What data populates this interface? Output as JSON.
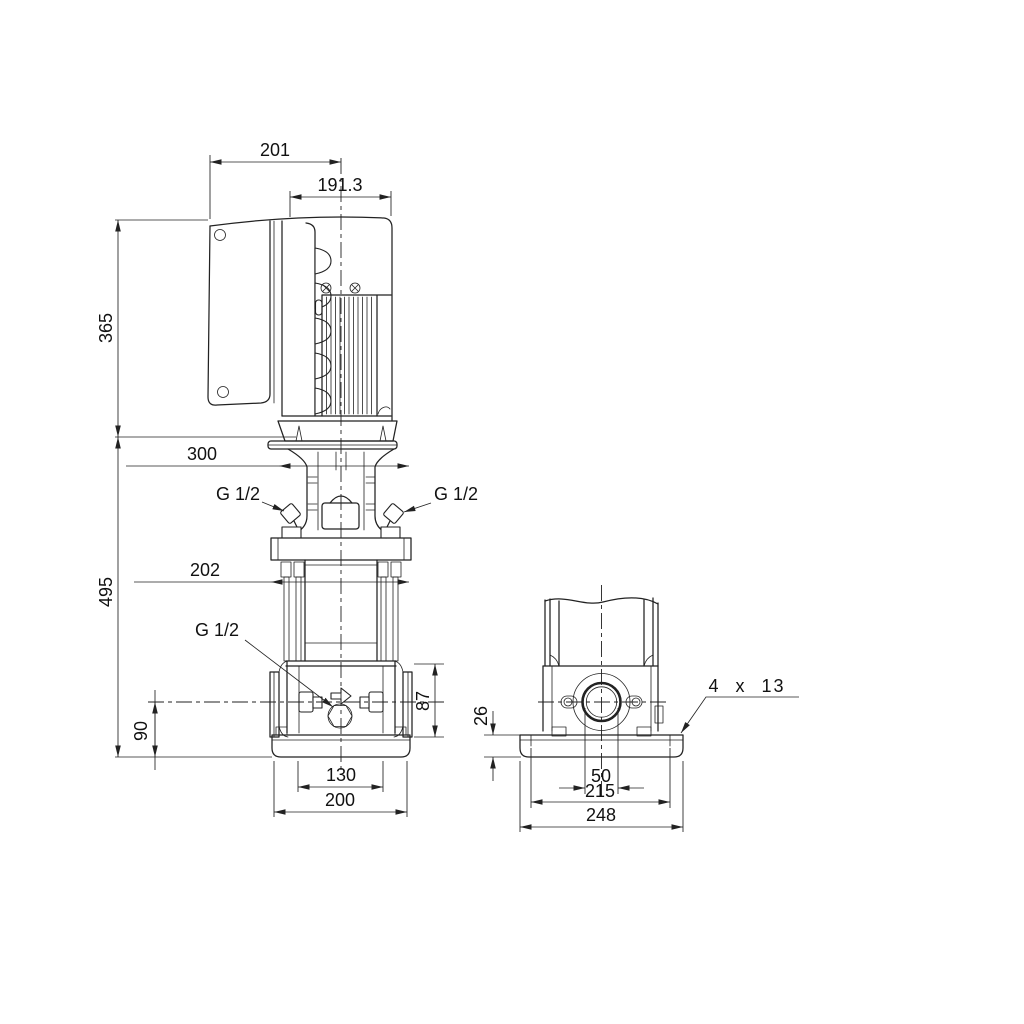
{
  "page": {
    "background_color": "#ffffff",
    "line_color": "#222222",
    "content_type": "pump-dimensional-drawing"
  },
  "drawing": {
    "views": {
      "side_view": {
        "dims": {
          "control_box_depth": "201",
          "motor_width": "191.3",
          "motor_height": "365",
          "head_depth": "300",
          "pump_height": "495",
          "head_width": "202",
          "port_height": "90",
          "base_section_height": "87",
          "foot_hole_spacing": "130",
          "base_depth": "200",
          "gauge_port_left": "G 1/2",
          "gauge_port_right": "G 1/2",
          "drain_port": "G 1/2"
        }
      },
      "end_view": {
        "dims": {
          "plate_thickness": "26",
          "port_bore": "50",
          "bolt_hole_spacing": "215",
          "base_width": "248",
          "foundation_holes": "4 x 13"
        }
      }
    }
  }
}
